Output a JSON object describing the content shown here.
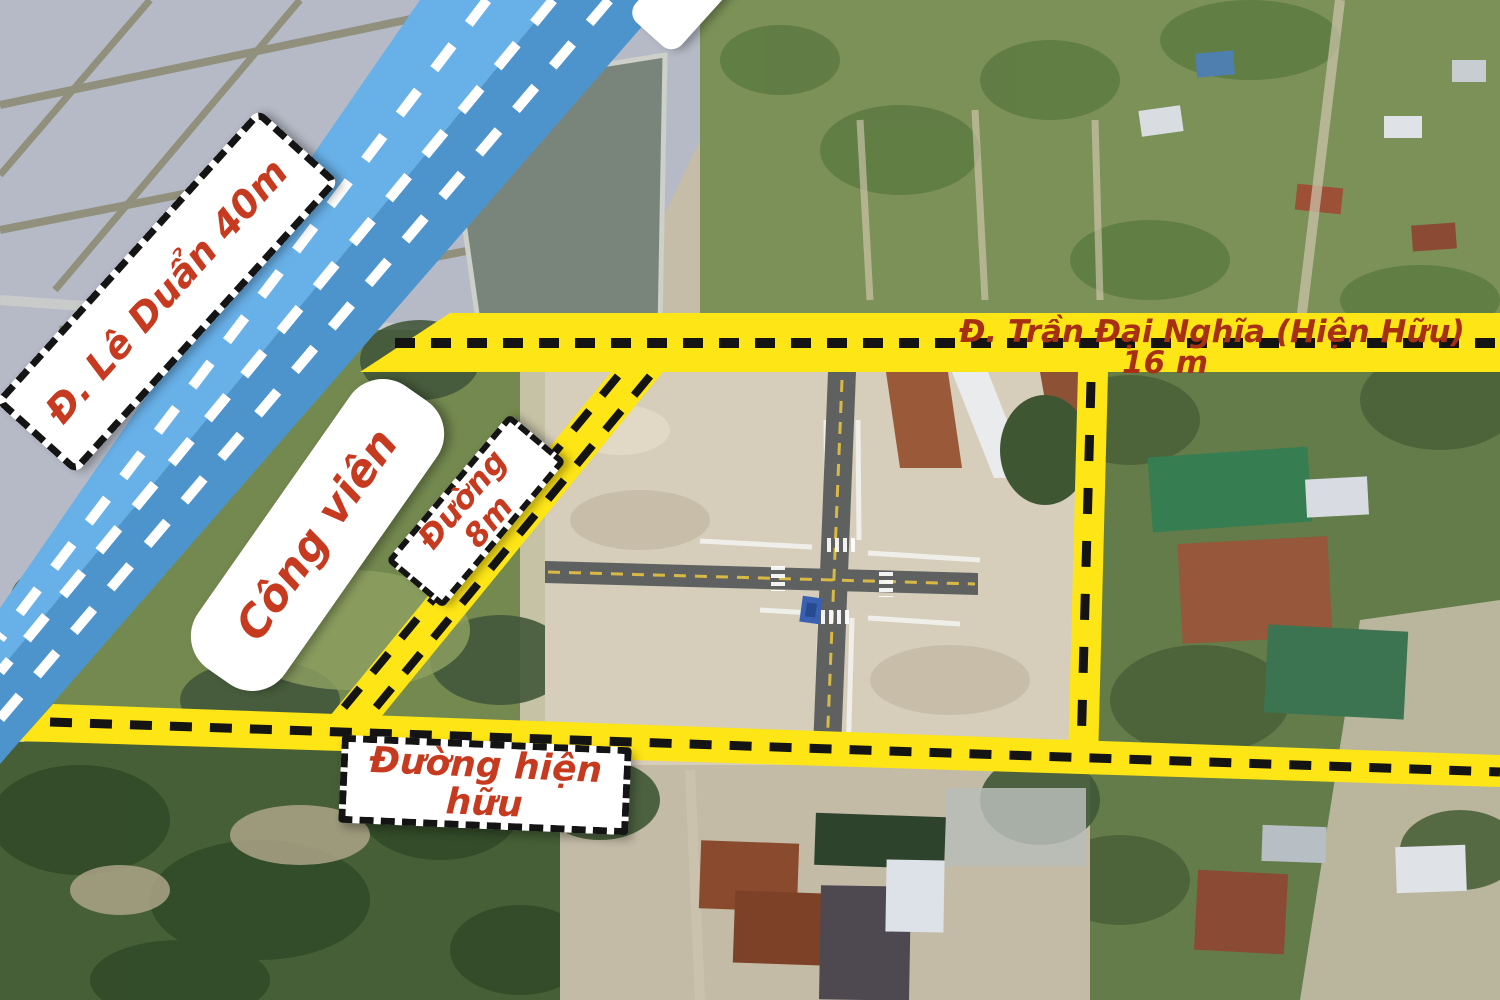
{
  "title": "Aerial land-plot map with planned road overlays",
  "colors": {
    "road_blue_light": "#68b0e8",
    "road_blue_dark": "#4e94cc",
    "road_yellow": "#fee516",
    "dash_white": "#ffffff",
    "dash_black": "#141414",
    "label_bg": "#ffffff",
    "label_red": "#c63b20",
    "label_red_dark": "#a83012",
    "pond_water": "#b5bac6",
    "pond_dike": "#8e8c74",
    "pond_dark": "#79857b",
    "orchard_green": "#7c9158",
    "trees_green": "#637c49",
    "left_green": "#74894f",
    "sand": "#d6cdbb",
    "sand_dim": "#c4bba6",
    "forest_dark": "#465f36",
    "asphalt": "#5f6160",
    "road_paint_yellow": "#d9b945"
  },
  "overlays": {
    "roads": {
      "le_duan": {
        "label": "Đ. Lê Duẩn 40m"
      },
      "tran_dai_nghia": {
        "label": "Đ. Trần Đại Nghĩa (Hiện Hữu)",
        "width_label": "16 m"
      },
      "duong_8m": {
        "label": "Đường 8m"
      },
      "hien_huu": {
        "label": "Đường hiện hữu"
      }
    },
    "areas": {
      "cong_vien": {
        "label": "Công viên"
      }
    }
  }
}
